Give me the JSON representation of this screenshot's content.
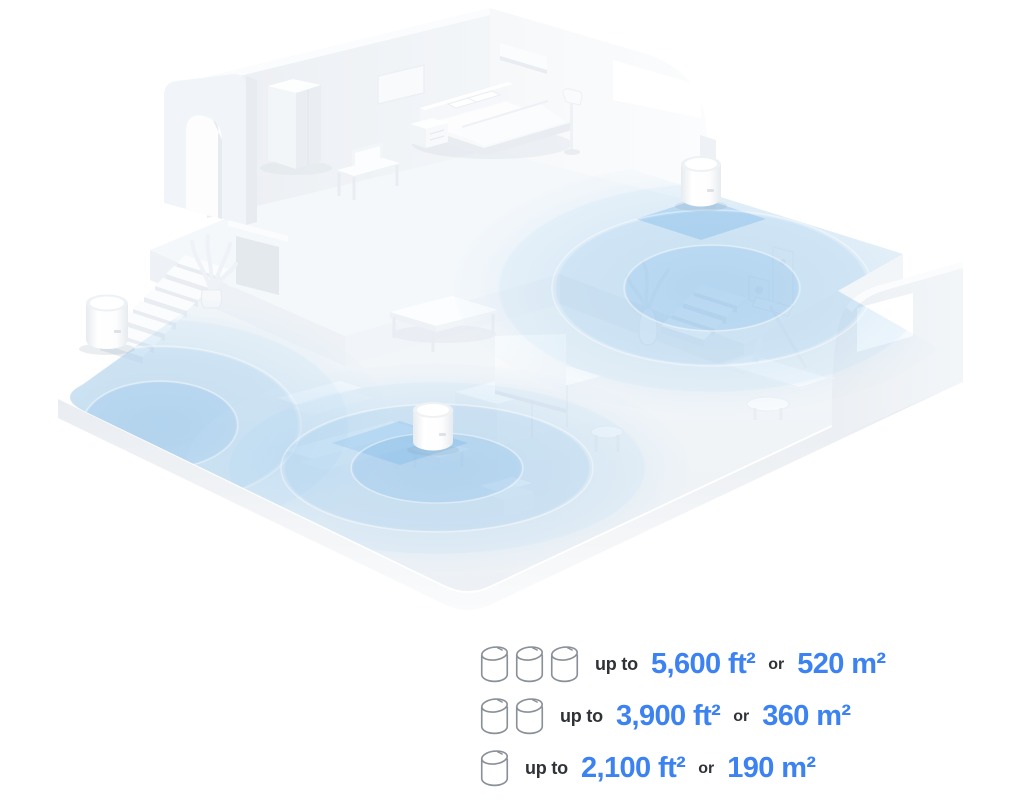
{
  "illustration": {
    "description": "Isometric white home floor plan with three mesh Wi-Fi units emitting blue circular coverage zones",
    "deco_unit_count": 3,
    "colors": {
      "coverage_blue": "#8FC3EA",
      "accent_blue": "#3C82F1",
      "text_dark": "#2F3237",
      "icon_stroke": "#8A9097"
    }
  },
  "legend": {
    "rows": [
      {
        "units": 3,
        "prefix": "up to",
        "area_ft": "5,600 ft²",
        "conjunction": "or",
        "area_m": "520 m²"
      },
      {
        "units": 2,
        "prefix": "up to",
        "area_ft": "3,900 ft²",
        "conjunction": "or",
        "area_m": "360 m²"
      },
      {
        "units": 1,
        "prefix": "up to",
        "area_ft": "2,100 ft²",
        "conjunction": "or",
        "area_m": "190 m²"
      }
    ]
  }
}
